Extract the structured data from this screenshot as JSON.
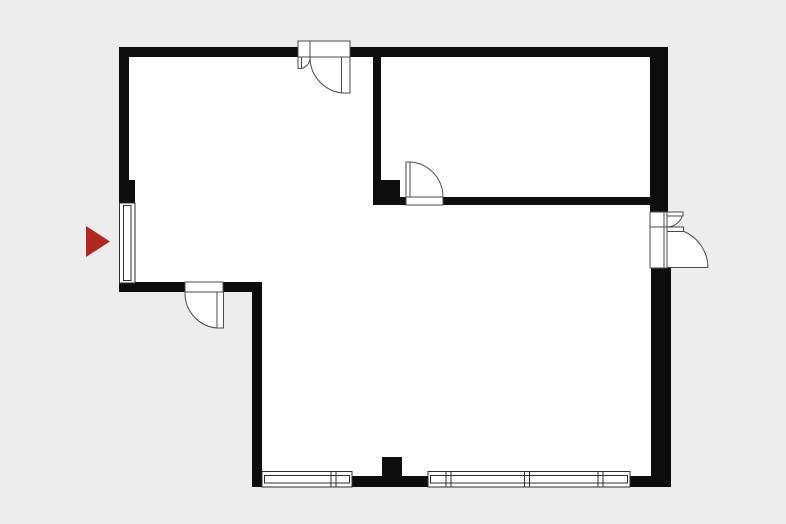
{
  "colors": {
    "background": "#ededed",
    "interior": "#ffffff",
    "wall": "#0d0d0d",
    "door_stroke": "#4a4a4a",
    "window_stroke": "#2e2e2e",
    "marker": "#b02920"
  },
  "plan": {
    "canvas": {
      "width": 786,
      "height": 524
    },
    "footprint": "119,47 668,47 668,487 252,487 252,292 119,292",
    "walls": [
      {
        "name": "wall-north",
        "x": 119,
        "y": 47,
        "w": 549,
        "h": 10
      },
      {
        "name": "wall-west-upper",
        "x": 119,
        "y": 47,
        "w": 10,
        "h": 133
      },
      {
        "name": "pier-west",
        "x": 119,
        "y": 180,
        "w": 16,
        "h": 23
      },
      {
        "name": "corner-west-bottom",
        "x": 119,
        "y": 283,
        "w": 16,
        "h": 9
      },
      {
        "name": "wall-leftroom-south-west",
        "x": 119,
        "y": 282,
        "w": 66,
        "h": 10
      },
      {
        "name": "wall-leftroom-south-east",
        "x": 223,
        "y": 282,
        "w": 39,
        "h": 10
      },
      {
        "name": "wall-west-lower",
        "x": 252,
        "y": 282,
        "w": 10,
        "h": 205
      },
      {
        "name": "wall-south-middle",
        "x": 352,
        "y": 476,
        "w": 76,
        "h": 11
      },
      {
        "name": "wall-south-east-corner",
        "x": 630,
        "y": 476,
        "w": 41,
        "h": 11
      },
      {
        "name": "pier-south",
        "x": 382,
        "y": 457,
        "w": 20,
        "h": 19
      },
      {
        "name": "wall-east-upper",
        "x": 650,
        "y": 47,
        "w": 18,
        "h": 165
      },
      {
        "name": "wall-east-lower",
        "x": 651,
        "y": 268,
        "w": 20,
        "h": 219
      },
      {
        "name": "wall-interior-vertical",
        "x": 373,
        "y": 57,
        "w": 8,
        "h": 140
      },
      {
        "name": "pier-interior",
        "x": 373,
        "y": 180,
        "w": 27,
        "h": 17
      },
      {
        "name": "wall-interior-horiz-west",
        "x": 373,
        "y": 197,
        "w": 34,
        "h": 8
      },
      {
        "name": "wall-interior-horiz-east",
        "x": 443,
        "y": 197,
        "w": 207,
        "h": 8
      }
    ],
    "windows": [
      {
        "name": "window-west",
        "orient": "v",
        "x": 119.5,
        "y": 203,
        "w": 15.5,
        "h": 80,
        "mullions": []
      },
      {
        "name": "window-south-1",
        "orient": "h",
        "x": 262,
        "y": 471.5,
        "w": 90,
        "h": 15.5,
        "mullions": [
          333.5
        ]
      },
      {
        "name": "window-south-2",
        "orient": "h",
        "x": 428,
        "y": 471.5,
        "w": 202,
        "h": 15.5,
        "mullions": [
          448.5,
          527,
          600.5
        ]
      }
    ],
    "doors": [
      {
        "name": "door-entrance-north",
        "frame": {
          "x": 298,
          "y": 41,
          "w": 52,
          "h": 16
        },
        "dividers": [
          [
            310,
            41,
            310,
            57
          ]
        ],
        "pies": [
          "M346 57 L310 57 A36 36 0 0 0 342 93 Z",
          "M299.5 57 L310 57 A11 11 0 0 1 301.5 68.5 Z"
        ],
        "leaves": [
          {
            "x": 341.5,
            "y": 57,
            "w": 8.5,
            "h": 36
          },
          {
            "x": 298,
            "y": 57,
            "w": 3.5,
            "h": 11.5
          }
        ]
      },
      {
        "name": "door-interior-room",
        "frame": {
          "x": 406,
          "y": 197,
          "w": 37,
          "h": 8
        },
        "dividers": [],
        "pies": [
          "M410 197 L410 162 A35 35 0 0 1 443 197 Z"
        ],
        "leaves": [
          {
            "x": 406,
            "y": 162,
            "w": 4,
            "h": 35
          }
        ]
      },
      {
        "name": "door-leftroom-south",
        "frame": {
          "x": 185,
          "y": 282,
          "w": 38,
          "h": 10
        },
        "dividers": [],
        "pies": [
          "M220 292 L185 292 A35 35 0 0 0 217 328 Z"
        ],
        "leaves": [
          {
            "x": 217,
            "y": 292,
            "w": 6.5,
            "h": 36
          }
        ]
      },
      {
        "name": "door-east-double",
        "frame": {
          "x": 650,
          "y": 212,
          "w": 17,
          "h": 56
        },
        "dividers": [
          [
            650,
            227,
            667,
            227
          ],
          [
            664,
            212,
            664,
            268
          ]
        ],
        "pies": [
          "M683 231 A40 40 0 0 1 708 267.5 L667 267.5 L667 231 Z",
          "M667 227 A16 16 0 0 0 683 212 L667 212 Z"
        ],
        "leaves": [
          {
            "x": 667,
            "y": 227,
            "w": 16.5,
            "h": 4.5
          },
          {
            "x": 667,
            "y": 212,
            "w": 16,
            "h": 4
          }
        ]
      }
    ],
    "marker": {
      "name": "entrance-arrow",
      "points": "86,226 110,241.5 86,257"
    }
  }
}
